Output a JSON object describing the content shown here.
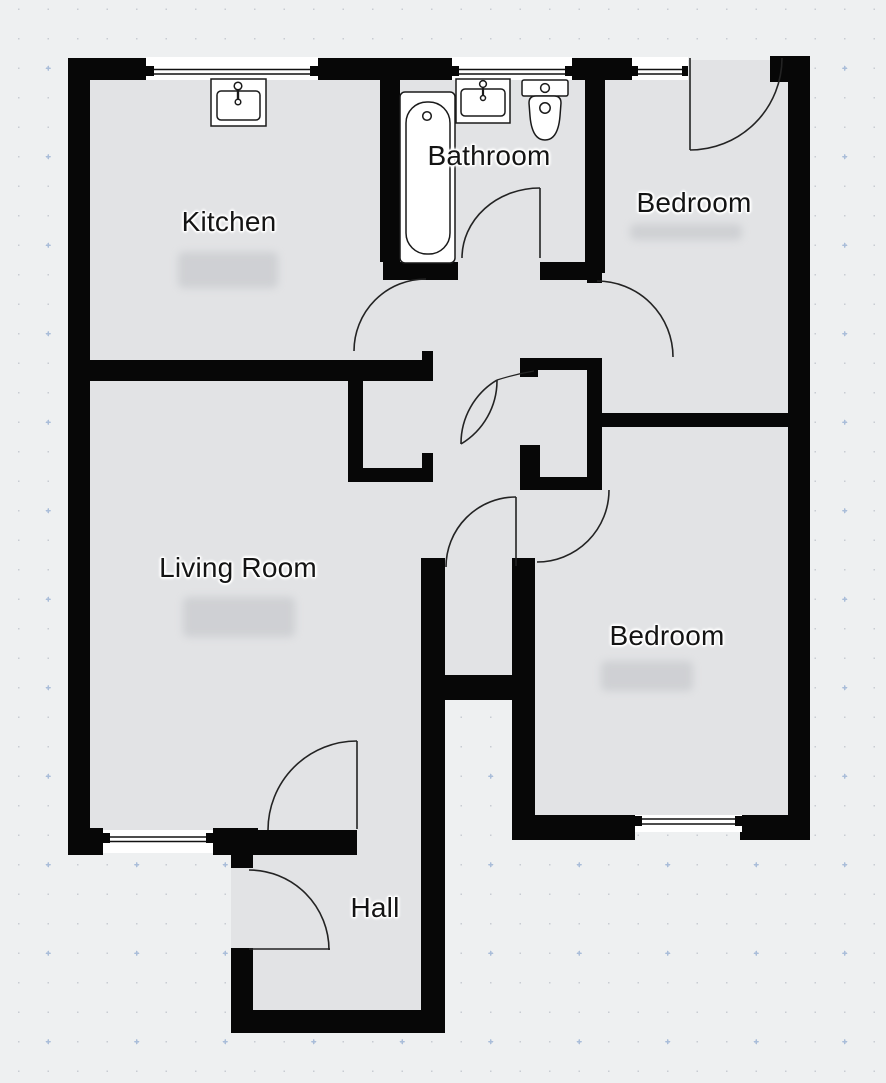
{
  "rooms": {
    "kitchen": {
      "label": "Kitchen"
    },
    "bathroom": {
      "label": "Bathroom"
    },
    "bedroom_top": {
      "label": "Bedroom"
    },
    "living_room": {
      "label": "Living Room"
    },
    "bedroom_bottom": {
      "label": "Bedroom"
    },
    "hall": {
      "label": "Hall"
    }
  },
  "fixtures": {
    "bathtub": "bathtub-icon",
    "toilet": "toilet-icon",
    "kitchen_sink": "sink-icon",
    "bathroom_sink": "sink-icon",
    "window": "window-icon",
    "door": "door-swing-arc-icon"
  },
  "colors": {
    "wall": "#070707",
    "floor": "#e2e3e5",
    "background": "#eef0f1",
    "dot": "#c8ccd2",
    "accent_dot": "#a9bdd9",
    "label_text": "#141414",
    "fixture_stroke": "#1a1a1a"
  }
}
